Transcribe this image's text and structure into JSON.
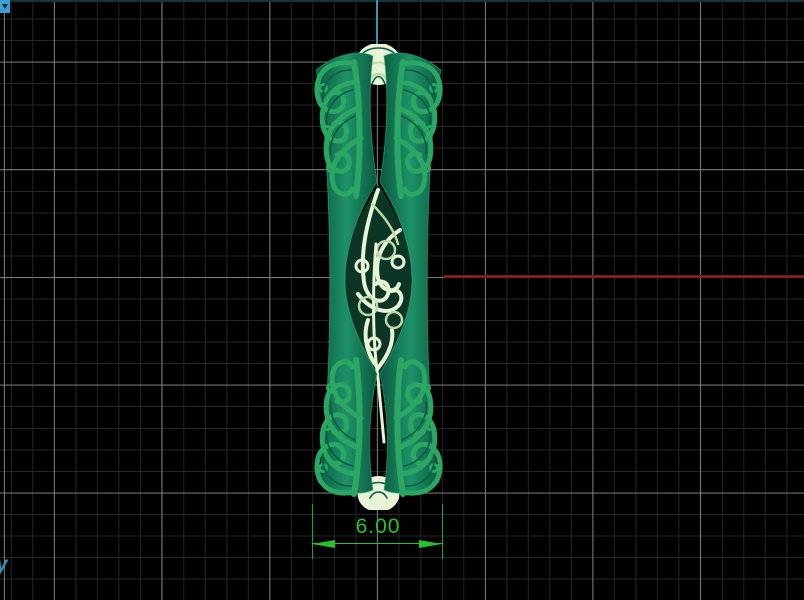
{
  "viewport": {
    "axis_label_y": "y",
    "icons": {
      "viewport_dropdown": "triangle-down"
    },
    "grid": {
      "minor_spacing_px": 21.5,
      "major_every": 5,
      "minor_color": "#262626",
      "major_color": "#808080",
      "background": "#000000"
    },
    "axes": {
      "vertical_axis_color": "#3a95a5",
      "horizontal_axis_color": "#9e2a20"
    }
  },
  "dimension": {
    "value": "6.00",
    "color": "#25c42e"
  },
  "model": {
    "name": "ornamental filigree ring band - side view",
    "body_color": "#107a57",
    "filigree_color": "#2ca763",
    "ornament_color": "#e8f4d6"
  }
}
